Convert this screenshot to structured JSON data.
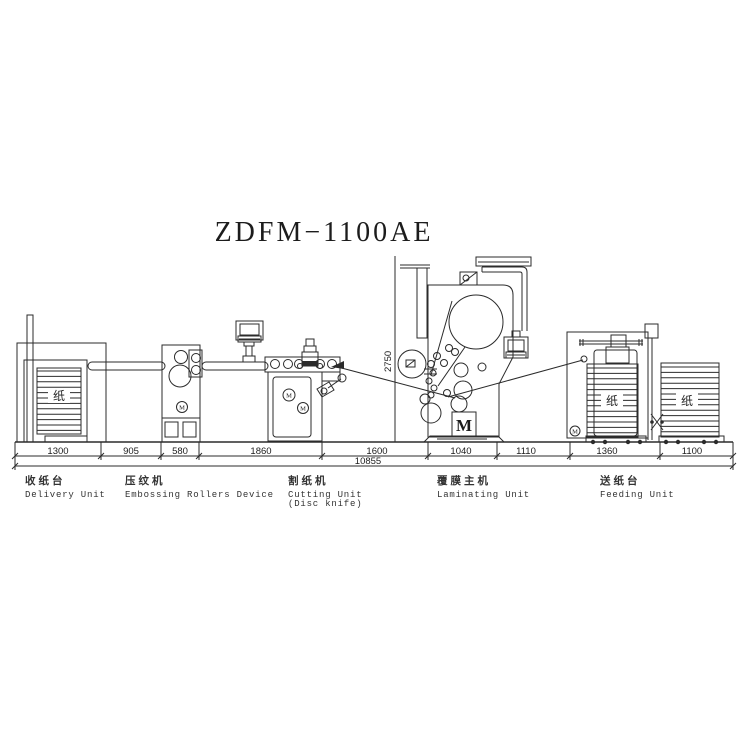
{
  "title": "ZDFM−1100AE",
  "dims": {
    "segments": [
      "1300",
      "905",
      "580",
      "1860",
      "1600",
      "1040",
      "1110",
      "1360",
      "1100"
    ],
    "total": "10855",
    "height": "2750"
  },
  "units": [
    {
      "zh": "收纸台",
      "en": "Delivery Unit"
    },
    {
      "zh": "压纹机",
      "en": "Embossing Rollers Device"
    },
    {
      "zh": "割纸机",
      "en": "Cutting Unit",
      "en2": "(Disc knife)"
    },
    {
      "zh": "覆膜主机",
      "en": "Laminating Unit"
    },
    {
      "zh": "送纸台",
      "en": "Feeding Unit"
    }
  ],
  "glyphs": {
    "motor": "M",
    "paper": "纸"
  }
}
